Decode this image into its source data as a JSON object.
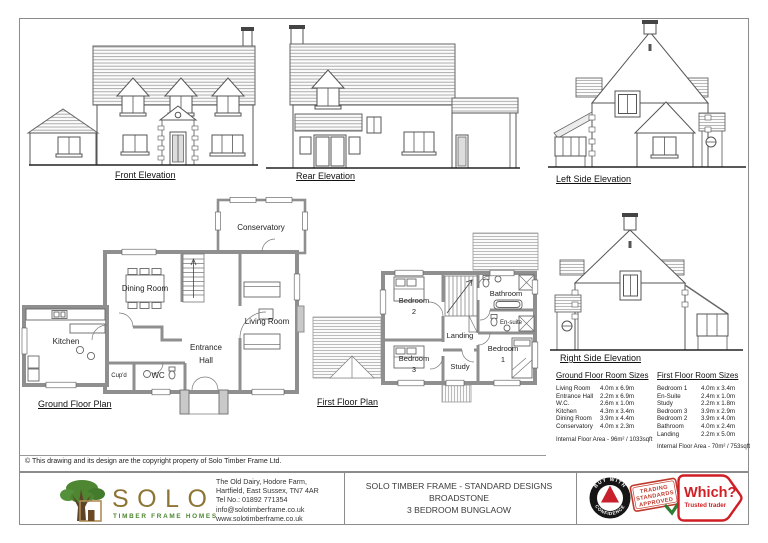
{
  "sheet": {
    "copyright": "© This drawing and its design are the copyright property of Solo Timber Frame Ltd."
  },
  "elevations": {
    "front": "Front Elevation",
    "rear": "Rear Elevation",
    "left": "Left Side Elevation",
    "right": "Right Side Elevation"
  },
  "plans": {
    "ground": {
      "label": "Ground Floor Plan",
      "rooms": {
        "kitchen": "Kitchen",
        "dining": "Dining Room",
        "living": "Living Room",
        "conservatory": "Conservatory",
        "entrance": {
          "line1": "Entrance",
          "line2": "Hall"
        },
        "wc": "WC",
        "cupd": "Cup'd"
      }
    },
    "first": {
      "label": "First Floor Plan",
      "rooms": {
        "bedroom1": {
          "line1": "Bedroom",
          "line2": "1"
        },
        "bedroom2": {
          "line1": "Bedroom",
          "line2": "2"
        },
        "bedroom3": {
          "line1": "Bedroom",
          "line2": "3"
        },
        "landing": "Landing",
        "study": "Study",
        "bathroom": "Bathroom",
        "ensuite": "En-suite"
      }
    }
  },
  "tables": {
    "ground": {
      "title": "Ground Floor Room Sizes",
      "rows": [
        {
          "room": "Living Room",
          "size": "4.0m x 6.9m"
        },
        {
          "room": "Entrance Hall",
          "size": "2.2m x 6.9m"
        },
        {
          "room": "W.C.",
          "size": "2.6m x 1.0m"
        },
        {
          "room": "Kitchen",
          "size": "4.3m x 3.4m"
        },
        {
          "room": "Dining Room",
          "size": "3.9m x 4.4m"
        },
        {
          "room": "Conservatory",
          "size": "4.0m x 2.3m"
        }
      ],
      "area": "Internal Floor Area - 96m² / 1033sqft"
    },
    "first": {
      "title": "First Floor Room Sizes",
      "rows": [
        {
          "room": "Bedroom 1",
          "size": "4.0m x 3.4m"
        },
        {
          "room": "En-Suite",
          "size": "2.4m x 1.0m"
        },
        {
          "room": "Study",
          "size": "2.2m x 1.8m"
        },
        {
          "room": "Bedroom 3",
          "size": "3.9m x 2.9m"
        },
        {
          "room": "Bedroom 2",
          "size": "3.9m x 4.0m"
        },
        {
          "room": "Bathroom",
          "size": "4.0m x 2.4m"
        },
        {
          "room": "Landing",
          "size": "2.2m x 5.0m"
        }
      ],
      "area": "Internal Floor Area - 70m² / 753sqft"
    }
  },
  "title_block": {
    "logo": {
      "name": "SOLO",
      "tagline": "TIMBER FRAME HOMES"
    },
    "address": {
      "line1": "The Old Dairy, Hodore Farm,",
      "line2": "Hartfield, East Sussex, TN7 4AR",
      "line3": "Tel No.: 01892 771354",
      "line4": "info@solotimberframe.co.uk",
      "line5": "www.solotimberframe.co.uk"
    },
    "project": {
      "line1": "SOLO TIMBER FRAME - STANDARD DESIGNS",
      "line2": "BROADSTONE",
      "line3": "3 BEDROOM  BUNGLAOW"
    },
    "badges": {
      "bwc": {
        "top": "BUY WITH",
        "bottom": "CONFIDENCE"
      },
      "stamp": {
        "line1": "TRADING",
        "line2": "STANDARDS",
        "line3": "APPROVED"
      },
      "which": {
        "brand": "Which?",
        "sub": "Trusted trader"
      }
    }
  },
  "colors": {
    "linework": "#555555",
    "wall_gray": "#8f8f8f",
    "logo_gold": "#8d7635",
    "logo_green": "#4e8631",
    "which_red": "#cf1f25",
    "stamp_red": "#c0392b",
    "check_green": "#2f7d32"
  },
  "icons": {
    "trading_standards_check": "✓"
  }
}
